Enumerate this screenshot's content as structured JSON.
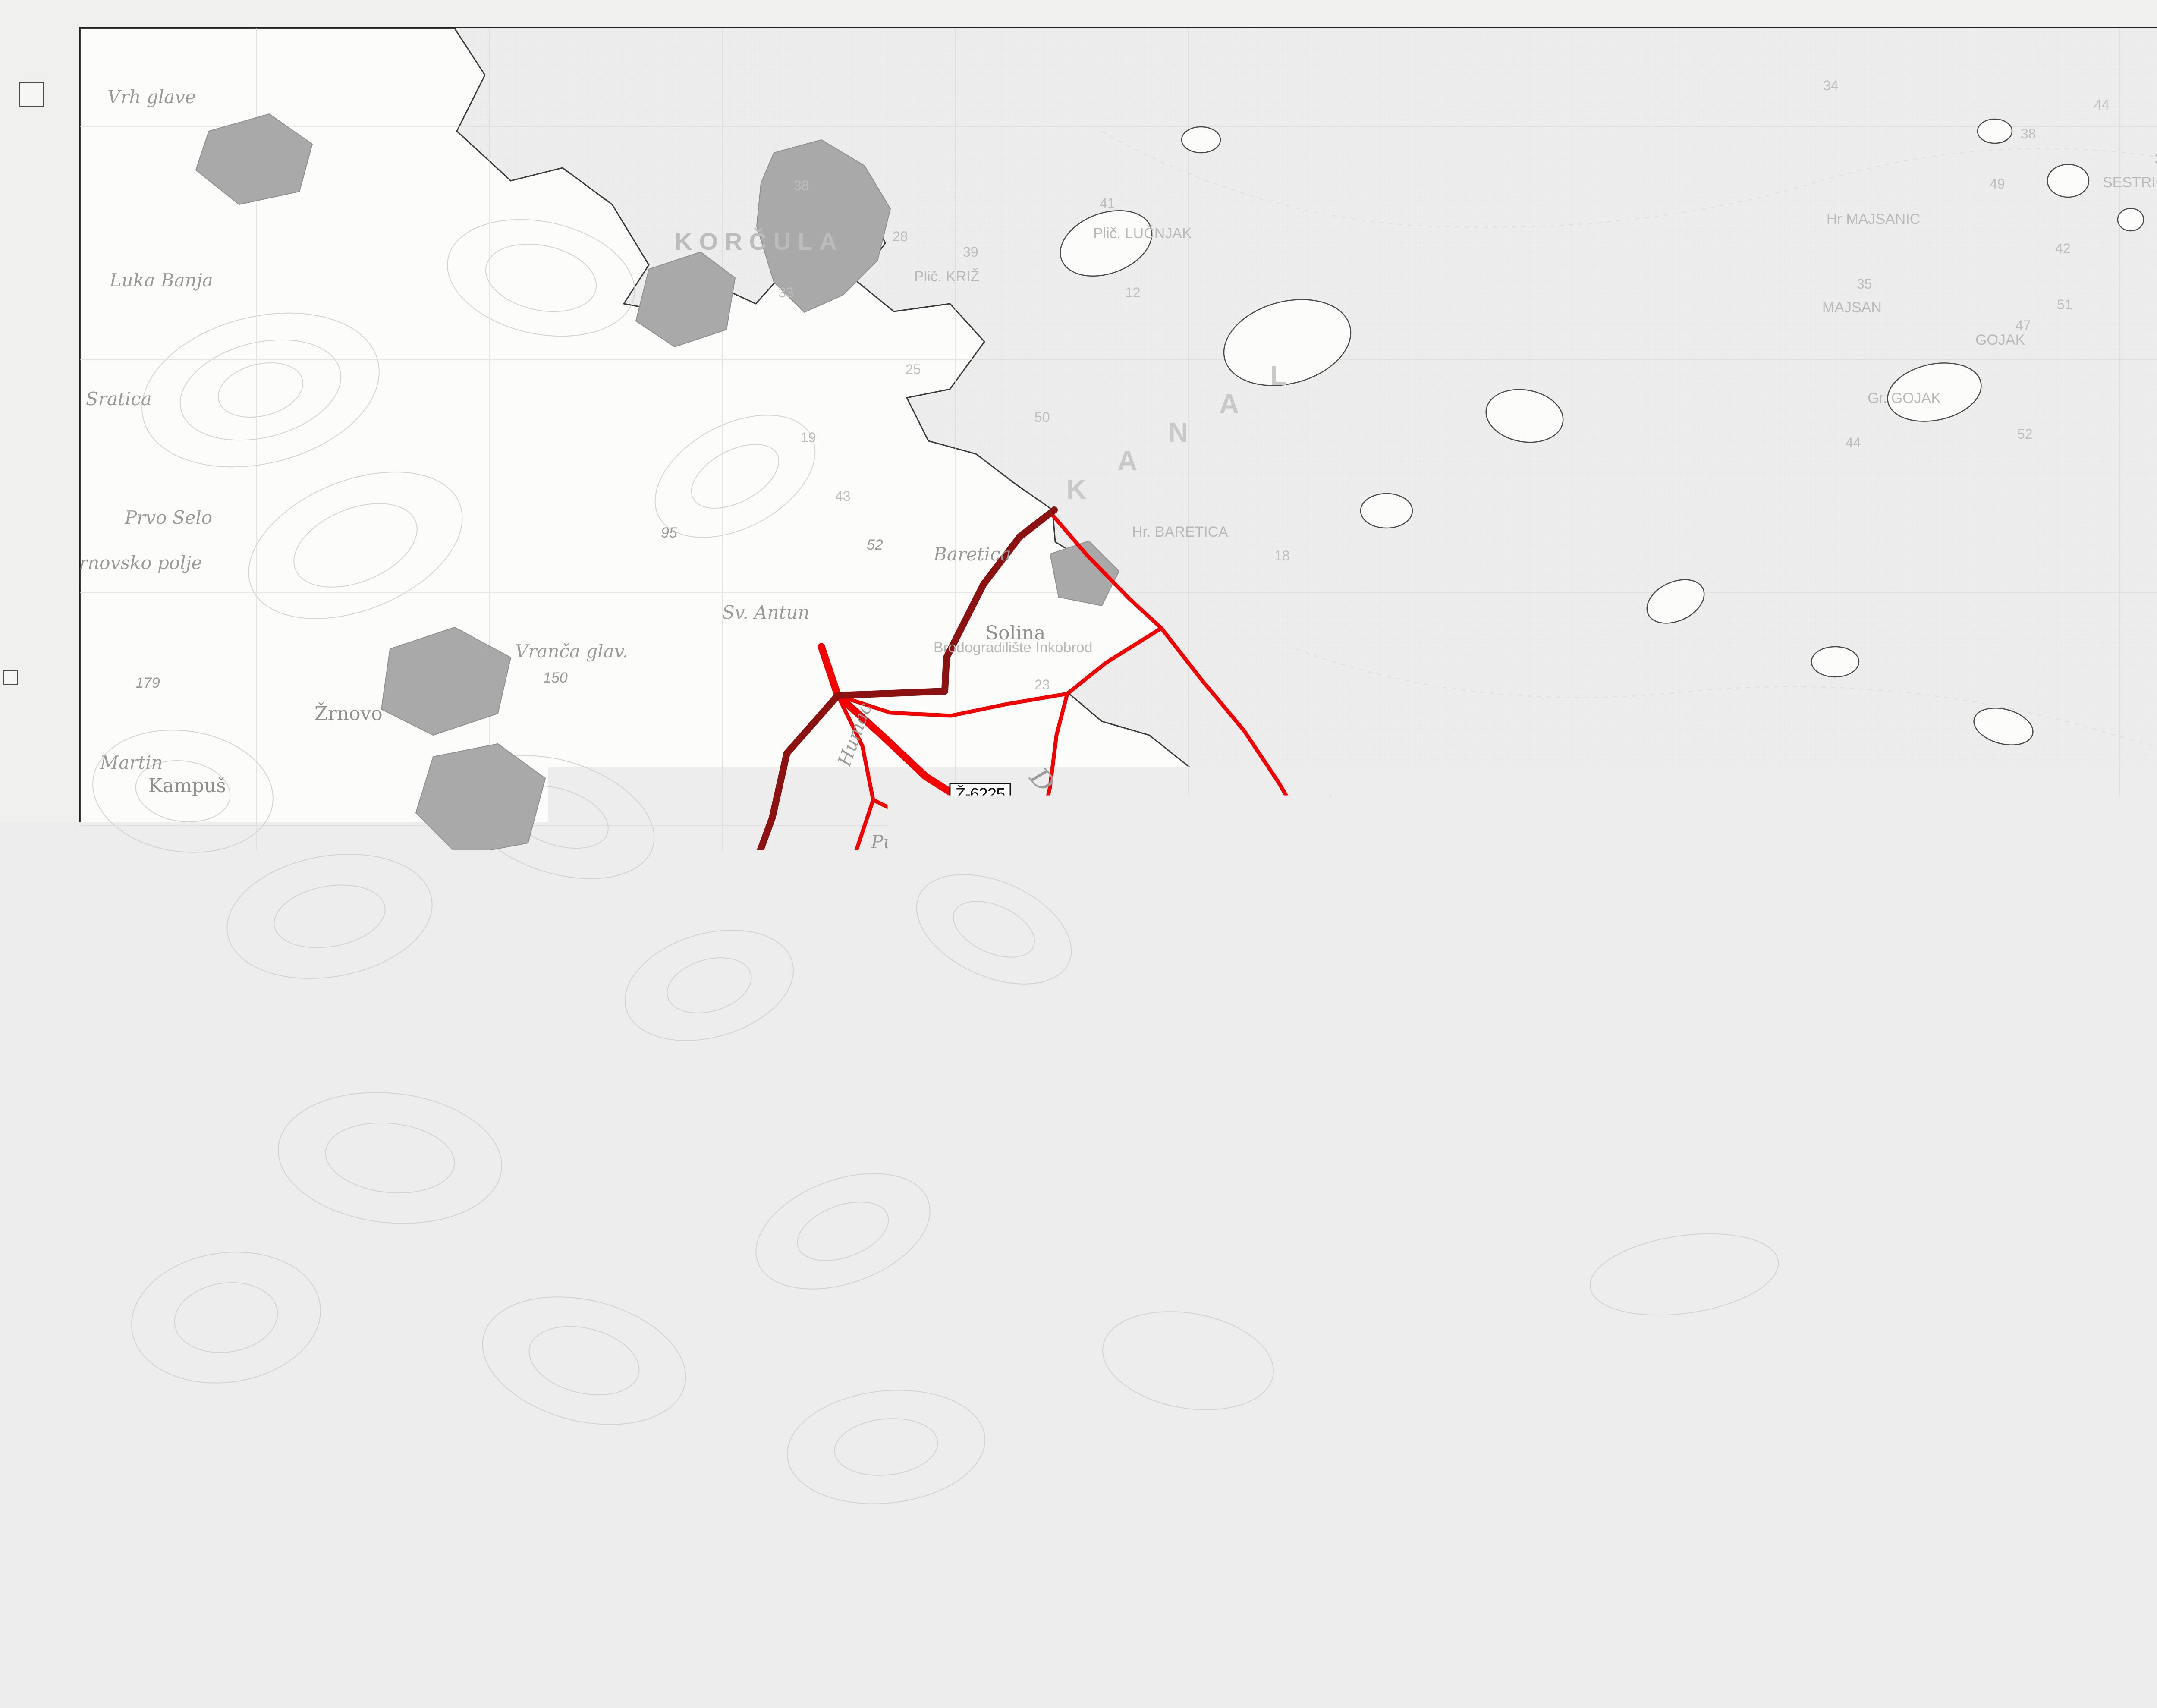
{
  "colors": {
    "road_red": "#f40000",
    "boundary_maroon": "#8c1111",
    "marina_fill": "#6fd6f6",
    "marina_blue": "#1552b8"
  },
  "title_block": {
    "title": "PROSTORNI PLAN UREĐENJA OPĆINE LUMBARDA",
    "sheet": "LIST 2a",
    "subtitle1": "INFRASTRUKTURNI SUSTAVI - PROMET -",
    "subtitle2": "- CESTOVNI, POMORSKI, ZRAČNI",
    "logo": "AF",
    "scale_0": "0 100m",
    "scale_1": "1000m",
    "scale_2": "2500m"
  },
  "legend": {
    "sheet": "LIST 2a",
    "header_title": "Infrastrukturni sustavi - promet - cestovni, pomorski, zračni",
    "col_existing": "postojeće",
    "col_planned": "planirano",
    "col_symbols": "TUMAČ ZNAKOVA",
    "sec_road": "CESTOVNI PROMET",
    "item_county_badge": "Ž-6225",
    "item_county": "ŽUPANIJSKA CESTE ( D-118 - LUMBARDA )",
    "item_other": "OSTALE CESTE",
    "sec_sea": "POMORSKI PROMET",
    "item_port_local": "MORSKA LUKA LOKALNOG ZNAČAJA",
    "item_port_special1": "MORSKA LUKA POSEBNE NAMJENE",
    "item_port_special2": "- LN - nautički turizam",
    "ln_badge": "LN",
    "sec_borders": "GRANICE",
    "item_border": "GRANICA OPĆINE"
  },
  "info_left": {
    "zupanija_label": "Županija:",
    "zupanija_value": "DUBROVAČKO-NERETVANSKA",
    "grad_label": "Grad:",
    "grad_value": "LUMBARDA",
    "naziv_plana_label": "Naziv prostornog plana:",
    "naziv_plana_value": "PROSTORNI PLAN UREĐENJA OPĆINE LUMBARDA",
    "naziv_prikaza_label": "Naziv kartografskog prikaza:",
    "naziv_prikaza_value": "INFRASTRUKTURNI SUSTAVI - PROMET - CESTOVNI, POMORSKI, ZRAČNI",
    "broj_label": "Broj kartografskog prikaza:",
    "broj_value": "2a",
    "mjerilo_label": "Mjerilo kartografskog prikaza:",
    "mjerilo_value": "1 : 25000",
    "pravna_label": "Pravna osoba / tijelo koje je izradilo plan:",
    "pravna_value1": "Sveučilište u Zagrebu, Arhitektonski fakultet",
    "pravna_value2": "ZAVOD ZA URBANIZAM I PROSTORNO PLANIRANJE",
    "pecat_label1": "Pečat pravne osobe / tijela",
    "pecat_label2": "koje je izradilo plan:",
    "odgovorna_label": "Odgovorna osoba:",
    "odgovorna_name": "Prof. dr. sc. Oleg Grgurević, dia, dipl.ing.šum",
    "koordinator_label": "Koordinator plana i glavni planer:",
    "koordinator_value": "Prof. dr. sc. Oleg Grgurević, dipl.ing.arh., dipl.ing.šum.",
    "tim_label": "Stručni tim u izradi plana:",
    "tim_a0": "1. Prof. dr. sc. Oleg Grgurević,",
    "tim_a1": "dipl.ing.arh., dipl.ing.šum.",
    "tim_a2": "2. Prof. dr. sc. Igor Fisković",
    "tim_a3": "3. Amalija Denich, dipl. agr.",
    "tim_a4": "4. Petra Škevin, dipl.ing.arh.",
    "tim_a5": "5. Sonja Petrinjak, dipl.ing.arh",
    "tim_b0": "6. Darija Maletić Mirko, dipl.ing.arh.",
    "tim_b1": "7. Martina Lulić, dipl.ing.arh."
  },
  "info_right": {
    "program_label1": "Program mjera za unapređenje stanja",
    "program_label2": "u prostoru (službeno glasilo):",
    "program_value1": "Službeni glasnik Dubrovačko-neretvanske",
    "program_value2": "županije br. 5 od 09. 07. 1999.",
    "odluka_label1": "Odluka predstavničkog tijela o donošenju",
    "odluka_label2": "plana (službeno glasilo):",
    "odluka_value": "27. 11. 1997.",
    "javna_label": "Javna rasprava - datum objave:",
    "javna_value": "17. 05. 1999.",
    "uvid_label": "Javni uvid održan",
    "uvid_value": "od 24. 05. 1999. do 24. 06. 1999.",
    "pecat_tijela_label1": "Pečat tijela odgovornog za provođenje",
    "pecat_tijela_label2": "javne rasprave:",
    "odg_osoba_label1": "Odgovorna osoba za provođenje",
    "odg_osoba_label2": "javne rasprave:",
    "odg_osoba_name": "N. Lipanović",
    "suglasnost1": "Suglasnost na plan prema članku   24.   Zakona o prostornom uređenju",
    "suglasnost2": "(\"Narodne novine\", br. 30/94, 68/98, 61/00 i 32/02.),",
    "broj_suglasnosti": "broj suglasnosti______, klasa_____ .",
    "datum": "datum:__________",
    "pecat_pred_label": "Pečat predstavničkog tijela:",
    "predsjednik_label": "Predsjednik predstavničkog tijela:",
    "istovjetnost_label1": "Istovjetnost ovog prostornog plana s",
    "istovjetnost_label2": "izvornikom ovjerava:",
    "pecat_nadleznog_label": "Pečat nadležnog tijela:"
  },
  "map": {
    "badge1": "Ž-6225",
    "badge2": "Ž-6225",
    "ln": "LN",
    "labels": [
      {
        "t": "KORČULA"
      },
      {
        "t": "O. KORČULA"
      },
      {
        "t": "Lumbarda"
      },
      {
        "t": "Knežić"
      },
      {
        "t": "Žrnovo"
      },
      {
        "t": "Sv. Antun"
      },
      {
        "t": "Baretica"
      },
      {
        "t": "Solina"
      },
      {
        "t": "Hr. BARETICA"
      },
      {
        "t": "Plič. KRIŽ"
      },
      {
        "t": "Plič. LUČNJAK"
      },
      {
        "t": "Donje blato"
      },
      {
        "t": "Gornje blato"
      },
      {
        "t": "Kampuš"
      },
      {
        "t": "Martin"
      },
      {
        "t": "Postrana"
      },
      {
        "t": "Postrana"
      },
      {
        "t": "Zamaslinjak"
      },
      {
        "t": "104"
      },
      {
        "t": "Mindel"
      },
      {
        "t": "V. straža"
      },
      {
        "t": "121"
      },
      {
        "t": "Garme"
      },
      {
        "t": "Gnjili brig"
      },
      {
        "t": "Kosovo"
      },
      {
        "t": "Krpač"
      },
      {
        "t": "Kaludrt"
      },
      {
        "t": "M. Glavica"
      },
      {
        "t": "V. Glavica"
      },
      {
        "t": "Krmača"
      },
      {
        "t": "Oblo br"
      },
      {
        "t": "180"
      },
      {
        "t": "Bultica"
      },
      {
        "t": "Jakasova peć"
      },
      {
        "t": "Zmilja br."
      },
      {
        "t": "Vranča glav."
      },
      {
        "t": "150"
      },
      {
        "t": "Klokolina"
      },
      {
        "t": "170"
      },
      {
        "t": "Okruglic"
      },
      {
        "t": "Žrnovsko polje"
      },
      {
        "t": "Brodogradilište Inkobrod"
      },
      {
        "t": "MAJSAN"
      },
      {
        "t": "Hr MAJSANIC"
      },
      {
        "t": "GOJAK"
      },
      {
        "t": "Gr. GOJAK"
      },
      {
        "t": "SESTRICA"
      },
      {
        "t": "K"
      },
      {
        "t": "A"
      },
      {
        "t": "N"
      },
      {
        "t": "A"
      },
      {
        "t": "L"
      },
      {
        "t": "Vrh glave"
      },
      {
        "t": "Luka Banja"
      },
      {
        "t": "Sratica"
      },
      {
        "t": "Prvo Selo"
      },
      {
        "t": "Humac"
      },
      {
        "t": "Pudarica"
      },
      {
        "t": "Baruza"
      },
      {
        "t": "88"
      },
      {
        "t": "U. Pržina"
      },
      {
        "t": "Prvi žal"
      },
      {
        "t": "Ražnjić"
      },
      {
        "t": "95"
      },
      {
        "t": "179"
      },
      {
        "t": "250"
      },
      {
        "t": "52"
      }
    ],
    "depths": [
      {
        "t": "34"
      },
      {
        "t": "44"
      },
      {
        "t": "38"
      },
      {
        "t": "49"
      },
      {
        "t": "36"
      },
      {
        "t": "42"
      },
      {
        "t": "17"
      },
      {
        "t": "35"
      },
      {
        "t": "53"
      },
      {
        "t": "51"
      },
      {
        "t": "47"
      },
      {
        "t": "56"
      },
      {
        "t": "58"
      },
      {
        "t": "57"
      },
      {
        "t": "52"
      },
      {
        "t": "44"
      },
      {
        "t": "38"
      },
      {
        "t": "28"
      },
      {
        "t": "39"
      },
      {
        "t": "33"
      },
      {
        "t": "25"
      },
      {
        "t": "12"
      },
      {
        "t": "19"
      },
      {
        "t": "43"
      },
      {
        "t": "15"
      },
      {
        "t": "18"
      },
      {
        "t": "41"
      },
      {
        "t": "23"
      },
      {
        "t": "50"
      }
    ]
  }
}
